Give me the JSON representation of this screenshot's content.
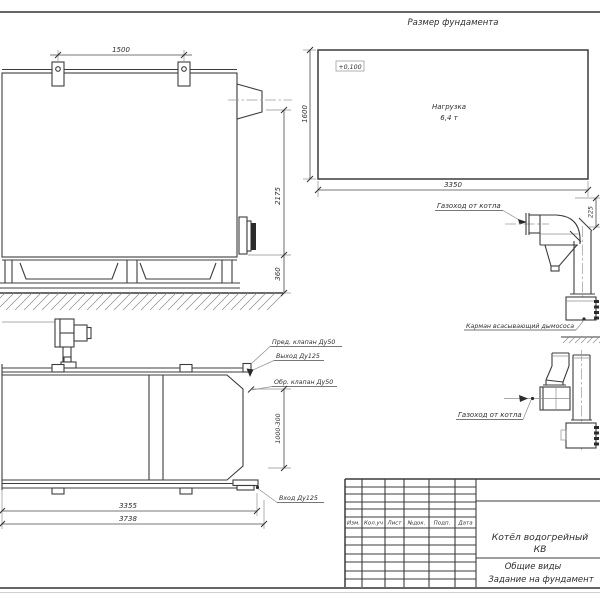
{
  "drawing": {
    "foundation": {
      "title": "Размер фундамента",
      "elevation_mark": "+0,100",
      "load_line1": "Нагрузка",
      "load_line2": "6,4 т",
      "dim_width": "3350",
      "dim_depth": "1600"
    },
    "side_view": {
      "dim_lug_spacing": "1500",
      "dim_height": "2175",
      "dim_base_height": "360"
    },
    "plan_view": {
      "label_safety_valve": "Пред. клапан Ду50",
      "label_outlet": "Выход Ду125",
      "label_check_valve": "Обр. клапан Ду50",
      "label_inlet": "Вход Ду125",
      "dim_nozzle_range": "1000-300",
      "dim_length_body": "3355",
      "dim_length_total": "3738"
    },
    "flue_side": {
      "label_flue": "Газоход от котла",
      "label_pocket": "Карман всасывающий дымососа",
      "dim_offset": "225"
    },
    "flue_plan": {
      "label_flue": "Газоход от котла"
    }
  },
  "title_block": {
    "columns": [
      "Изм.",
      "Кол.уч",
      "Лист",
      "№док.",
      "Подп.",
      "Дата"
    ],
    "product_line1": "Котёл водогрейный",
    "product_line2": "КВ",
    "doc_line1": "Общие виды",
    "doc_line2": "Задание на фундамент"
  }
}
